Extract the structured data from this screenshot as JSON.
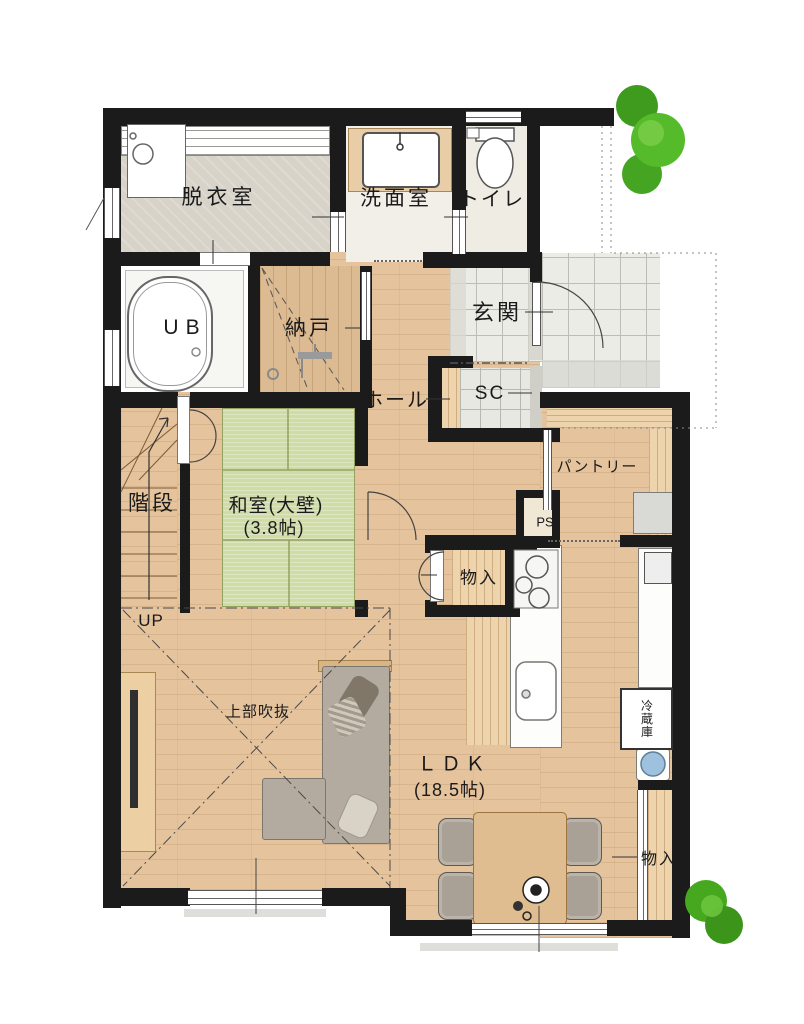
{
  "plan": {
    "title": "1F floor plan",
    "labels": {
      "datsui": "脱衣室",
      "senmen": "洗面室",
      "toilet": "トイレ",
      "ub": "UB",
      "nando": "納戸",
      "genkan": "玄関",
      "hall": "ホール",
      "sc": "SC",
      "kaidan": "階段",
      "up": "UP",
      "washitsu": "和室(大壁)",
      "washitsu_size": "(3.8帖)",
      "pantry": "パントリー",
      "ps": "PS",
      "monoire_kitchen": "物入",
      "fukinuke": "上部吹抜",
      "ldk": "ＬＤＫ",
      "ldk_size": "(18.5帖)",
      "reizouko": "冷蔵庫",
      "monoire_east": "物入"
    },
    "colors": {
      "wall": "#1b1b1b",
      "wood_floor": "#e5c39d",
      "tatami": "#cedca6",
      "tile": "#ececе7",
      "grey_floor": "#d8d3c9",
      "tree_green": "#4db02a",
      "bin_blue": "#9ec1dd"
    }
  }
}
